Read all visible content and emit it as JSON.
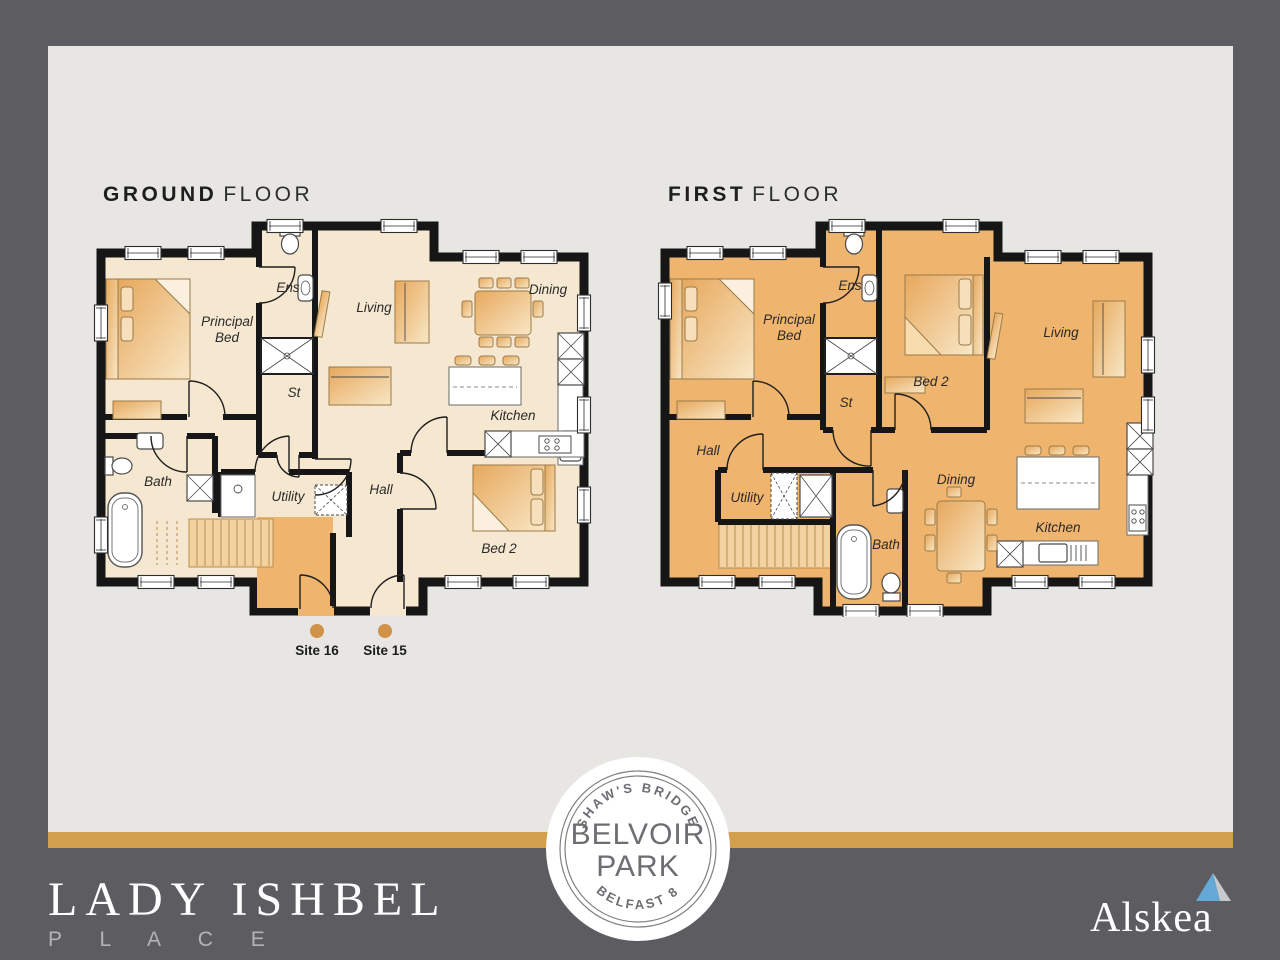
{
  "titles": {
    "ground": {
      "strong": "GROUND",
      "light": "FLOOR"
    },
    "first": {
      "strong": "FIRST",
      "light": "FLOOR"
    }
  },
  "ground_floor": {
    "rooms": {
      "ens": "Ens",
      "principal_l1": "Principal",
      "principal_l2": "Bed",
      "living": "Living",
      "dining": "Dining",
      "st": "St",
      "kitchen": "Kitchen",
      "bath": "Bath",
      "utility": "Utility",
      "hall": "Hall",
      "bed2": "Bed 2"
    },
    "sites": {
      "site16": "Site 16",
      "site15": "Site 15"
    }
  },
  "first_floor": {
    "rooms": {
      "ens": "Ens",
      "principal_l1": "Principal",
      "principal_l2": "Bed",
      "bed2": "Bed 2",
      "living": "Living",
      "st": "St",
      "hall": "Hall",
      "utility": "Utility",
      "bath": "Bath",
      "dining": "Dining",
      "kitchen": "Kitchen"
    }
  },
  "badge": {
    "top": "SHAW'S BRIDGE",
    "main1": "BELVOIR",
    "main2": "PARK",
    "bottom": "BELFAST 8"
  },
  "brand": {
    "name": "LADY ISHBEL",
    "sub": "P L A C E"
  },
  "logo": {
    "name": "Alskea"
  },
  "colors": {
    "bg": "#5d5d61",
    "card": "#e7e6e3",
    "gold": "#d2a04c",
    "cream": "#f6e8d0",
    "orange": "#efb46d",
    "wall": "#161616",
    "label": "#2a2a2a",
    "badge_text": "#6c6e72",
    "brand_sub": "#b3b4b7",
    "site_dot": "#d09248",
    "logo_blue": "#64a8d8",
    "logo_gray": "#c6cacd"
  }
}
